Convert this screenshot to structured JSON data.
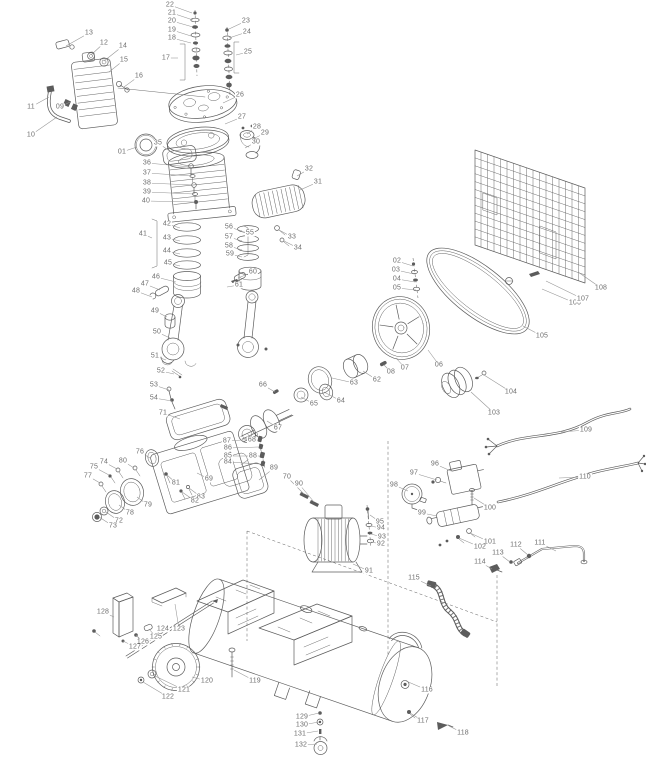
{
  "diagram": {
    "colors": {
      "background": "#ffffff",
      "line": "#5c5c5c",
      "label": "#6e6e6e",
      "leader": "#949494"
    },
    "labels": [
      {
        "t": "13",
        "x": 89,
        "y": 33,
        "lx": 66,
        "ly": 46
      },
      {
        "t": "12",
        "x": 104,
        "y": 43,
        "lx": 91,
        "ly": 55
      },
      {
        "t": "14",
        "x": 123,
        "y": 46,
        "lx": 104,
        "ly": 61
      },
      {
        "t": "15",
        "x": 124,
        "y": 60,
        "lx": 109,
        "ly": 72
      },
      {
        "t": "16",
        "x": 139,
        "y": 76,
        "lx": 124,
        "ly": 87
      },
      {
        "t": "11",
        "x": 31,
        "y": 107,
        "lx": 49,
        "ly": 97
      },
      {
        "t": "09",
        "x": 60,
        "y": 107,
        "lx": 70,
        "ly": 102
      },
      {
        "t": "10",
        "x": 31,
        "y": 135,
        "lx": 57,
        "ly": 117
      },
      {
        "t": "22",
        "x": 170,
        "y": 5,
        "lx": 192,
        "ly": 13
      },
      {
        "t": "21",
        "x": 172,
        "y": 13,
        "lx": 193,
        "ly": 20
      },
      {
        "t": "20",
        "x": 172,
        "y": 21,
        "lx": 193,
        "ly": 27
      },
      {
        "t": "19",
        "x": 172,
        "y": 30,
        "lx": 191,
        "ly": 36
      },
      {
        "t": "18",
        "x": 172,
        "y": 38,
        "lx": 191,
        "ly": 43
      },
      {
        "t": "17",
        "x": 166,
        "y": 58,
        "lx": 178,
        "ly": 58
      },
      {
        "t": "23",
        "x": 246,
        "y": 21,
        "lx": 229,
        "ly": 29
      },
      {
        "t": "24",
        "x": 247,
        "y": 32,
        "lx": 229,
        "ly": 38
      },
      {
        "t": "25",
        "x": 248,
        "y": 52,
        "lx": 236,
        "ly": 55
      },
      {
        "t": "26",
        "x": 240,
        "y": 95,
        "lx": 223,
        "ly": 103
      },
      {
        "t": "27",
        "x": 242,
        "y": 117,
        "lx": 225,
        "ly": 124
      },
      {
        "t": "28",
        "x": 257,
        "y": 127,
        "lx": 247,
        "ly": 134
      },
      {
        "t": "29",
        "x": 265,
        "y": 133,
        "lx": 253,
        "ly": 139
      },
      {
        "t": "30",
        "x": 256,
        "y": 142,
        "lx": 245,
        "ly": 148
      },
      {
        "t": "32",
        "x": 309,
        "y": 169,
        "lx": 297,
        "ly": 176
      },
      {
        "t": "31",
        "x": 318,
        "y": 182,
        "lx": 300,
        "ly": 190
      },
      {
        "t": "01",
        "x": 122,
        "y": 152,
        "lx": 137,
        "ly": 147
      },
      {
        "t": "35",
        "x": 158,
        "y": 143,
        "lx": 171,
        "ly": 152
      },
      {
        "t": "33",
        "x": 292,
        "y": 237,
        "lx": 279,
        "ly": 230
      },
      {
        "t": "34",
        "x": 298,
        "y": 248,
        "lx": 284,
        "ly": 241
      },
      {
        "t": "36",
        "x": 147,
        "y": 163,
        "lx": 191,
        "ly": 167
      },
      {
        "t": "37",
        "x": 147,
        "y": 173,
        "lx": 192,
        "ly": 176
      },
      {
        "t": "38",
        "x": 147,
        "y": 183,
        "lx": 193,
        "ly": 185
      },
      {
        "t": "39",
        "x": 147,
        "y": 192,
        "lx": 194,
        "ly": 194
      },
      {
        "t": "40",
        "x": 146,
        "y": 201,
        "lx": 195,
        "ly": 202
      },
      {
        "t": "41",
        "x": 143,
        "y": 234,
        "lx": 152,
        "ly": 238
      },
      {
        "t": "42",
        "x": 167,
        "y": 224,
        "lx": 180,
        "ly": 228
      },
      {
        "t": "43",
        "x": 167,
        "y": 238,
        "lx": 180,
        "ly": 241
      },
      {
        "t": "44",
        "x": 167,
        "y": 251,
        "lx": 180,
        "ly": 254
      },
      {
        "t": "45",
        "x": 168,
        "y": 263,
        "lx": 180,
        "ly": 266
      },
      {
        "t": "46",
        "x": 156,
        "y": 277,
        "lx": 176,
        "ly": 282
      },
      {
        "t": "47",
        "x": 145,
        "y": 284,
        "lx": 160,
        "ly": 290
      },
      {
        "t": "48",
        "x": 136,
        "y": 291,
        "lx": 152,
        "ly": 297
      },
      {
        "t": "49",
        "x": 155,
        "y": 311,
        "lx": 167,
        "ly": 317
      },
      {
        "t": "50",
        "x": 157,
        "y": 332,
        "lx": 170,
        "ly": 338
      },
      {
        "t": "51",
        "x": 155,
        "y": 356,
        "lx": 166,
        "ly": 360
      },
      {
        "t": "52",
        "x": 161,
        "y": 371,
        "lx": 174,
        "ly": 374
      },
      {
        "t": "53",
        "x": 154,
        "y": 385,
        "lx": 169,
        "ly": 390
      },
      {
        "t": "54",
        "x": 154,
        "y": 398,
        "lx": 172,
        "ly": 401
      },
      {
        "t": "71",
        "x": 163,
        "y": 413,
        "lx": 180,
        "ly": 419
      },
      {
        "t": "55",
        "x": 250,
        "y": 233,
        "lx": 245,
        "ly": 236
      },
      {
        "t": "56",
        "x": 229,
        "y": 227,
        "lx": 242,
        "ly": 231
      },
      {
        "t": "57",
        "x": 229,
        "y": 237,
        "lx": 242,
        "ly": 241
      },
      {
        "t": "58",
        "x": 229,
        "y": 246,
        "lx": 242,
        "ly": 250
      },
      {
        "t": "59",
        "x": 230,
        "y": 254,
        "lx": 242,
        "ly": 257
      },
      {
        "t": "60",
        "x": 253,
        "y": 272,
        "lx": 238,
        "ly": 278
      },
      {
        "t": "61",
        "x": 239,
        "y": 285,
        "lx": 227,
        "ly": 287
      },
      {
        "t": "66",
        "x": 263,
        "y": 385,
        "lx": 275,
        "ly": 392
      },
      {
        "t": "65",
        "x": 314,
        "y": 404,
        "lx": 301,
        "ly": 397
      },
      {
        "t": "67",
        "x": 278,
        "y": 428,
        "lx": 267,
        "ly": 421
      },
      {
        "t": "68",
        "x": 252,
        "y": 440,
        "lx": 247,
        "ly": 433
      },
      {
        "t": "62",
        "x": 377,
        "y": 380,
        "lx": 363,
        "ly": 371
      },
      {
        "t": "63",
        "x": 354,
        "y": 383,
        "lx": 332,
        "ly": 378
      },
      {
        "t": "64",
        "x": 341,
        "y": 401,
        "lx": 324,
        "ly": 392
      },
      {
        "t": "02",
        "x": 397,
        "y": 261,
        "lx": 413,
        "ly": 266
      },
      {
        "t": "03",
        "x": 396,
        "y": 270,
        "lx": 414,
        "ly": 274
      },
      {
        "t": "04",
        "x": 397,
        "y": 279,
        "lx": 415,
        "ly": 282
      },
      {
        "t": "05",
        "x": 397,
        "y": 288,
        "lx": 416,
        "ly": 290
      },
      {
        "t": "08",
        "x": 391,
        "y": 372,
        "lx": 384,
        "ly": 365
      },
      {
        "t": "07",
        "x": 405,
        "y": 368,
        "lx": 396,
        "ly": 358
      },
      {
        "t": "06",
        "x": 439,
        "y": 365,
        "lx": 428,
        "ly": 350
      },
      {
        "t": "87",
        "x": 227,
        "y": 441,
        "lx": 257,
        "ly": 439
      },
      {
        "t": "86",
        "x": 228,
        "y": 448,
        "lx": 258,
        "ly": 447
      },
      {
        "t": "85",
        "x": 228,
        "y": 456,
        "lx": 259,
        "ly": 456
      },
      {
        "t": "84",
        "x": 228,
        "y": 462,
        "lx": 260,
        "ly": 464
      },
      {
        "t": "69",
        "x": 209,
        "y": 479,
        "lx": 197,
        "ly": 473
      },
      {
        "t": "88",
        "x": 253,
        "y": 456,
        "lx": 241,
        "ly": 465
      },
      {
        "t": "89",
        "x": 274,
        "y": 468,
        "lx": 259,
        "ly": 480
      },
      {
        "t": "70",
        "x": 287,
        "y": 477,
        "lx": 304,
        "ly": 494
      },
      {
        "t": "90",
        "x": 299,
        "y": 484,
        "lx": 314,
        "ly": 502
      },
      {
        "t": "76",
        "x": 140,
        "y": 452,
        "lx": 150,
        "ly": 458
      },
      {
        "t": "74",
        "x": 104,
        "y": 462,
        "lx": 117,
        "ly": 469
      },
      {
        "t": "75",
        "x": 94,
        "y": 467,
        "lx": 109,
        "ly": 475
      },
      {
        "t": "80",
        "x": 123,
        "y": 461,
        "lx": 134,
        "ly": 468
      },
      {
        "t": "77",
        "x": 88,
        "y": 476,
        "lx": 100,
        "ly": 483
      },
      {
        "t": "79",
        "x": 148,
        "y": 505,
        "lx": 137,
        "ly": 497
      },
      {
        "t": "78",
        "x": 130,
        "y": 513,
        "lx": 119,
        "ly": 505
      },
      {
        "t": "72",
        "x": 119,
        "y": 521,
        "lx": 106,
        "ly": 512
      },
      {
        "t": "73",
        "x": 113,
        "y": 526,
        "lx": 99,
        "ly": 517
      },
      {
        "t": "81",
        "x": 176,
        "y": 483,
        "lx": 167,
        "ly": 475
      },
      {
        "t": "83",
        "x": 201,
        "y": 497,
        "lx": 189,
        "ly": 488
      },
      {
        "t": "82",
        "x": 195,
        "y": 501,
        "lx": 182,
        "ly": 492
      },
      {
        "t": "95",
        "x": 380,
        "y": 522,
        "lx": 370,
        "ly": 515
      },
      {
        "t": "94",
        "x": 381,
        "y": 528,
        "lx": 370,
        "ly": 526
      },
      {
        "t": "93",
        "x": 382,
        "y": 537,
        "lx": 371,
        "ly": 534
      },
      {
        "t": "92",
        "x": 381,
        "y": 544,
        "lx": 371,
        "ly": 542
      },
      {
        "t": "91",
        "x": 369,
        "y": 571,
        "lx": 353,
        "ly": 564
      },
      {
        "t": "96",
        "x": 435,
        "y": 464,
        "lx": 451,
        "ly": 471
      },
      {
        "t": "97",
        "x": 414,
        "y": 473,
        "lx": 437,
        "ly": 480
      },
      {
        "t": "98",
        "x": 394,
        "y": 485,
        "lx": 408,
        "ly": 491
      },
      {
        "t": "99",
        "x": 422,
        "y": 513,
        "lx": 437,
        "ly": 516
      },
      {
        "t": "100",
        "x": 490,
        "y": 508,
        "lx": 474,
        "ly": 498
      },
      {
        "t": "101",
        "x": 490,
        "y": 542,
        "lx": 470,
        "ly": 533
      },
      {
        "t": "102",
        "x": 480,
        "y": 547,
        "lx": 459,
        "ly": 538
      },
      {
        "t": "109",
        "x": 586,
        "y": 430,
        "lx": 561,
        "ly": 432
      },
      {
        "t": "110",
        "x": 585,
        "y": 477,
        "lx": 559,
        "ly": 478
      },
      {
        "t": "103",
        "x": 494,
        "y": 413,
        "lx": 471,
        "ly": 392
      },
      {
        "t": "104",
        "x": 511,
        "y": 392,
        "lx": 484,
        "ly": 375
      },
      {
        "t": "105",
        "x": 542,
        "y": 336,
        "lx": 523,
        "ly": 326
      },
      {
        "t": "106",
        "x": 575,
        "y": 303,
        "lx": 542,
        "ly": 289
      },
      {
        "t": "107",
        "x": 583,
        "y": 299,
        "lx": 546,
        "ly": 281
      },
      {
        "t": "108",
        "x": 601,
        "y": 288,
        "lx": 578,
        "ly": 272
      },
      {
        "t": "111",
        "x": 540,
        "y": 543,
        "lx": 556,
        "ly": 551
      },
      {
        "t": "112",
        "x": 516,
        "y": 545,
        "lx": 528,
        "ly": 555
      },
      {
        "t": "113",
        "x": 498,
        "y": 553,
        "lx": 510,
        "ly": 562
      },
      {
        "t": "114",
        "x": 480,
        "y": 562,
        "lx": 492,
        "ly": 569
      },
      {
        "t": "115",
        "x": 414,
        "y": 578,
        "lx": 431,
        "ly": 586
      },
      {
        "t": "116",
        "x": 427,
        "y": 690,
        "lx": 406,
        "ly": 681
      },
      {
        "t": "117",
        "x": 423,
        "y": 721,
        "lx": 410,
        "ly": 713
      },
      {
        "t": "118",
        "x": 463,
        "y": 733,
        "lx": 449,
        "ly": 726
      },
      {
        "t": "128",
        "x": 103,
        "y": 612,
        "lx": 114,
        "ly": 617
      },
      {
        "t": "124",
        "x": 163,
        "y": 629,
        "lx": 153,
        "ly": 637
      },
      {
        "t": "123",
        "x": 179,
        "y": 629,
        "lx": 175,
        "ly": 604
      },
      {
        "t": "125",
        "x": 156,
        "y": 637,
        "lx": 149,
        "ly": 629
      },
      {
        "t": "126",
        "x": 143,
        "y": 642,
        "lx": 136,
        "ly": 635
      },
      {
        "t": "127",
        "x": 135,
        "y": 647,
        "lx": 123,
        "ly": 641
      },
      {
        "t": "120",
        "x": 207,
        "y": 681,
        "lx": 192,
        "ly": 677
      },
      {
        "t": "121",
        "x": 184,
        "y": 690,
        "lx": 155,
        "ly": 676
      },
      {
        "t": "122",
        "x": 168,
        "y": 697,
        "lx": 143,
        "ly": 682
      },
      {
        "t": "119",
        "x": 255,
        "y": 681,
        "lx": 234,
        "ly": 670
      },
      {
        "t": "129",
        "x": 302,
        "y": 717,
        "lx": 319,
        "ly": 713
      },
      {
        "t": "130",
        "x": 302,
        "y": 725,
        "lx": 319,
        "ly": 722
      },
      {
        "t": "131",
        "x": 300,
        "y": 734,
        "lx": 318,
        "ly": 731
      },
      {
        "t": "132",
        "x": 301,
        "y": 745,
        "lx": 317,
        "ly": 744
      }
    ]
  }
}
